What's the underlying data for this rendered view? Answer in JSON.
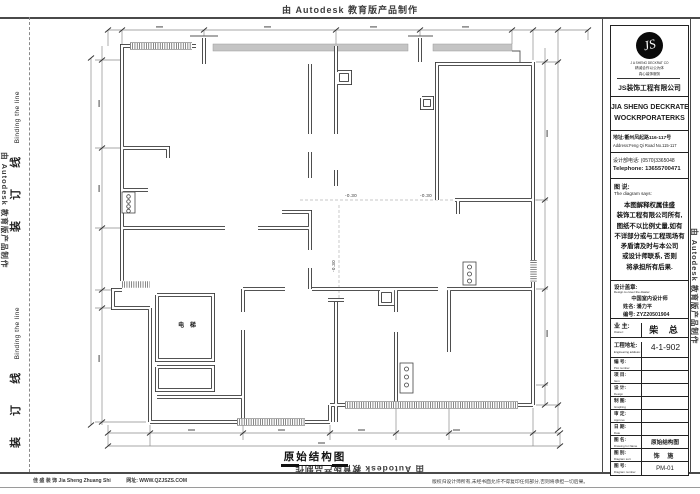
{
  "colors": {
    "wall_line": "#3a3a3a",
    "band_gray": "#c4c4c4",
    "frame": "#4a4a4a"
  },
  "stamps": {
    "autodesk": "由 Autodesk 教育版产品制作",
    "binding_cn": "装 订 线",
    "binding_en": "Binding the line"
  },
  "plan": {
    "elevator_label": "电 梯",
    "level_label_1": "-0.30",
    "level_label_2": "-0.30",
    "level_label_3": "-0.30",
    "title": "原始结构图"
  },
  "title_block": {
    "logo": {
      "monogram": "JS",
      "sub1": "J A SHENG DECKRAT CO",
      "sub2": "精诚合作以公为体",
      "sub3": "真心装饰服务",
      "company_cn": "JS装饰工程有限公司"
    },
    "company_en_1": "JIA SHENG DECKRATE",
    "company_en_2": "WOCKRPORATERKS",
    "address_cn": "地址:衢州凤起路116-117号",
    "address_en": "Address:Feng Qi Road No.115-117",
    "phone_cn": "设计部电话: (0570)3365048",
    "phone_en": "Telephone: 13655700471",
    "says_cn": "图 说:",
    "says_en": "The diagram says:",
    "disclaimer": [
      "本图解释权属佳盛",
      "装饰工程有限公司所有,",
      "图纸不以比例丈量,如有",
      "不详部分或与工程现场有",
      "矛盾请及时与本公司",
      "或设计师联系, 否则",
      "将承担所有后果."
    ],
    "seal_cn": "设计盖章:",
    "seal_en": "Design to cover the diaster",
    "designer_title": "中国室内设计师",
    "designer_name": "姓名: 潘力平",
    "designer_no": "编号: ZYZ20501904",
    "owner_label": "业 主:",
    "owner_en": "Owner:",
    "owner_value": "柴  总",
    "site_label": "工程地址:",
    "site_en": "Engineering address:",
    "site_value": "4-1-902",
    "rows": [
      {
        "cn": "编 号:",
        "en": "Plot number",
        "value": ""
      },
      {
        "cn": "项 目:",
        "en": "Item",
        "value": ""
      },
      {
        "cn": "设 计:",
        "en": "Design",
        "value": ""
      },
      {
        "cn": "制 图:",
        "en": "Graphing",
        "value": ""
      },
      {
        "cn": "审 定:",
        "en": "Approve",
        "value": ""
      },
      {
        "cn": "日 期:",
        "en": "Date",
        "value": ""
      },
      {
        "cn": "图 名:",
        "en": "Drawing for Name",
        "value": "原始结构图"
      },
      {
        "cn": "图 别:",
        "en": "Diagram sort",
        "value": "饰 施"
      },
      {
        "cn": "图 号:",
        "en": "Diagram number",
        "value": "PM-01"
      }
    ]
  },
  "footer": {
    "company": "佳 盛 装 饰  Jia Sheng Zhuang Shi",
    "website": "网址: WWW.QZJSZS.COM",
    "copyright": "版权归设计师所有,未经书面允许不得复印任何部分,否则将承担一切后果。"
  }
}
